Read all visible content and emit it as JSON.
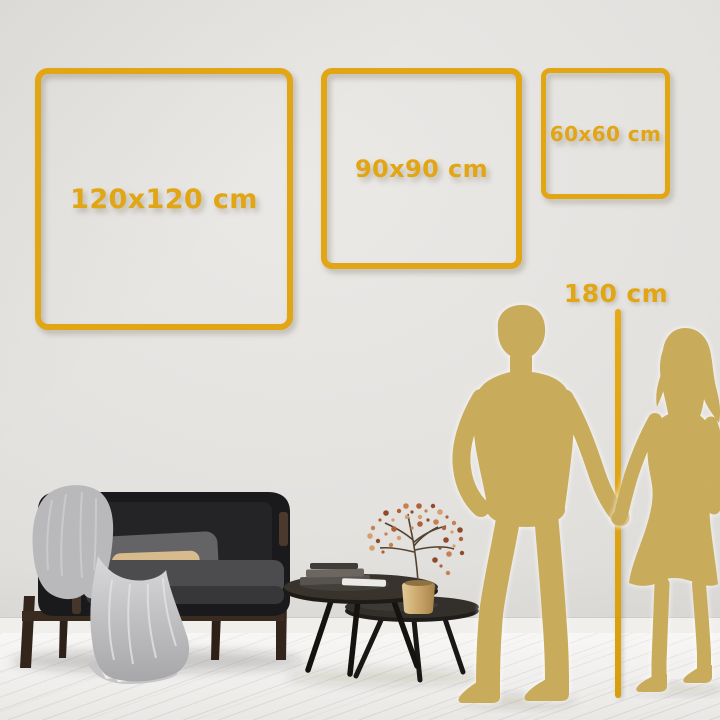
{
  "size_guide": {
    "frames": [
      {
        "label": "120x120 cm"
      },
      {
        "label": "90x90 cm"
      },
      {
        "label": "60x60 cm"
      }
    ],
    "height_reference": {
      "label": "180 cm"
    }
  },
  "palette": {
    "gold_accent": "#e2a513",
    "silhouette_gold": "#c9ab5c",
    "wall": "#e4e2df",
    "floor": "#f3f2f0"
  },
  "scene": {
    "objects": [
      "sofa-loveseat",
      "throw-blanket",
      "gray-pillow",
      "beige-pillow",
      "coffee-table-large",
      "coffee-table-small",
      "book-stack",
      "gold-vase",
      "dried-flower-branch",
      "man-silhouette",
      "woman-silhouette",
      "height-ruler-line"
    ]
  }
}
